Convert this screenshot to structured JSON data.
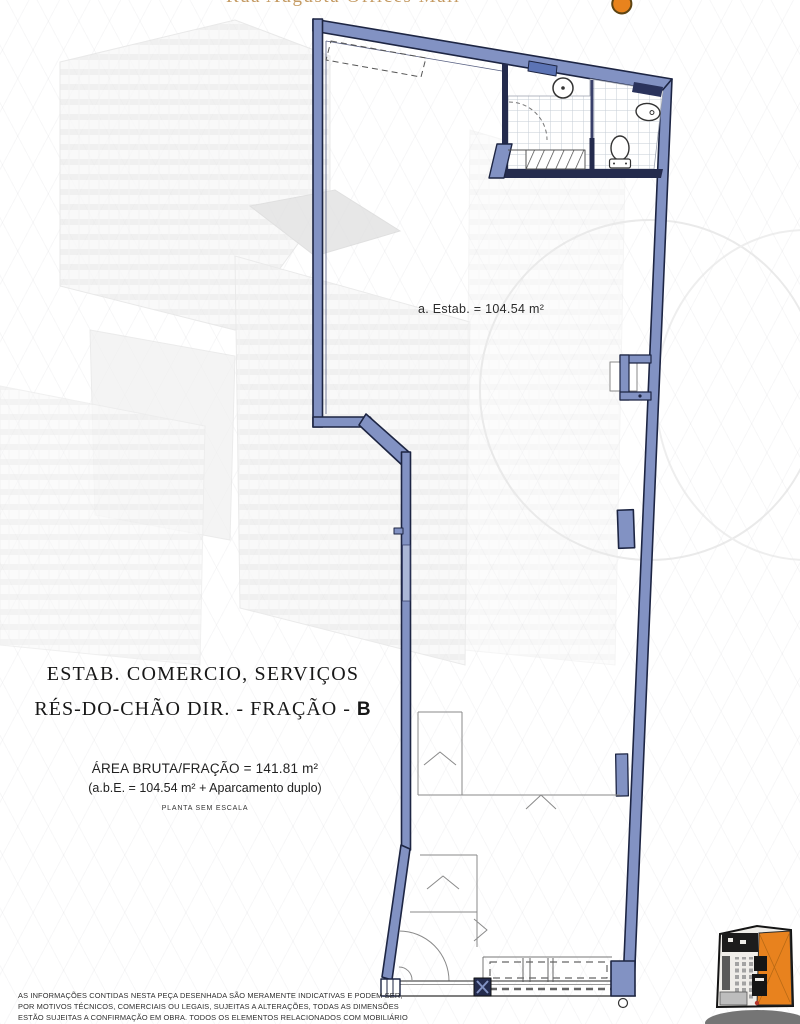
{
  "header": {
    "clipped_title": "Rua Augusta Offices Mall",
    "logo_color": "#e8831d"
  },
  "plan": {
    "area_label": "a. Estab. = 104.54 m²",
    "wall_fill_color": "#8292c3",
    "wall_border_color": "#1d2543"
  },
  "title_block": {
    "line1": "ESTAB. COMERCIO, SERVIÇOS",
    "line2_prefix": "RÉS-DO-CHÃO DIR. - FRAÇÃO - ",
    "line2_fraction": "B"
  },
  "area_block": {
    "line1": "ÁREA BRUTA/FRAÇÃO = 141.81 m²",
    "line2": "(a.b.E. = 104.54 m² + Aparcamento duplo)",
    "line3": "PLANTA SEM ESCALA"
  },
  "disclaimer": {
    "line1": "AS INFORMAÇÕES CONTIDAS NESTA PEÇA DESENHADA SÃO MERAMENTE INDICATIVAS E PODEM SER,",
    "line2": "POR MOTIVOS TÉCNICOS, COMERCIAIS OU LEGAIS, SUJEITAS A ALTERAÇÕES, TODAS AS DIMENSÕES",
    "line3": "ESTÃO SUJEITAS A CONFIRMAÇÃO EM OBRA. TODOS  OS ELEMENTOS RELACIONADOS COM MOBILIÁRIO"
  },
  "minimap": {
    "highlight_color": "#e8821e"
  }
}
